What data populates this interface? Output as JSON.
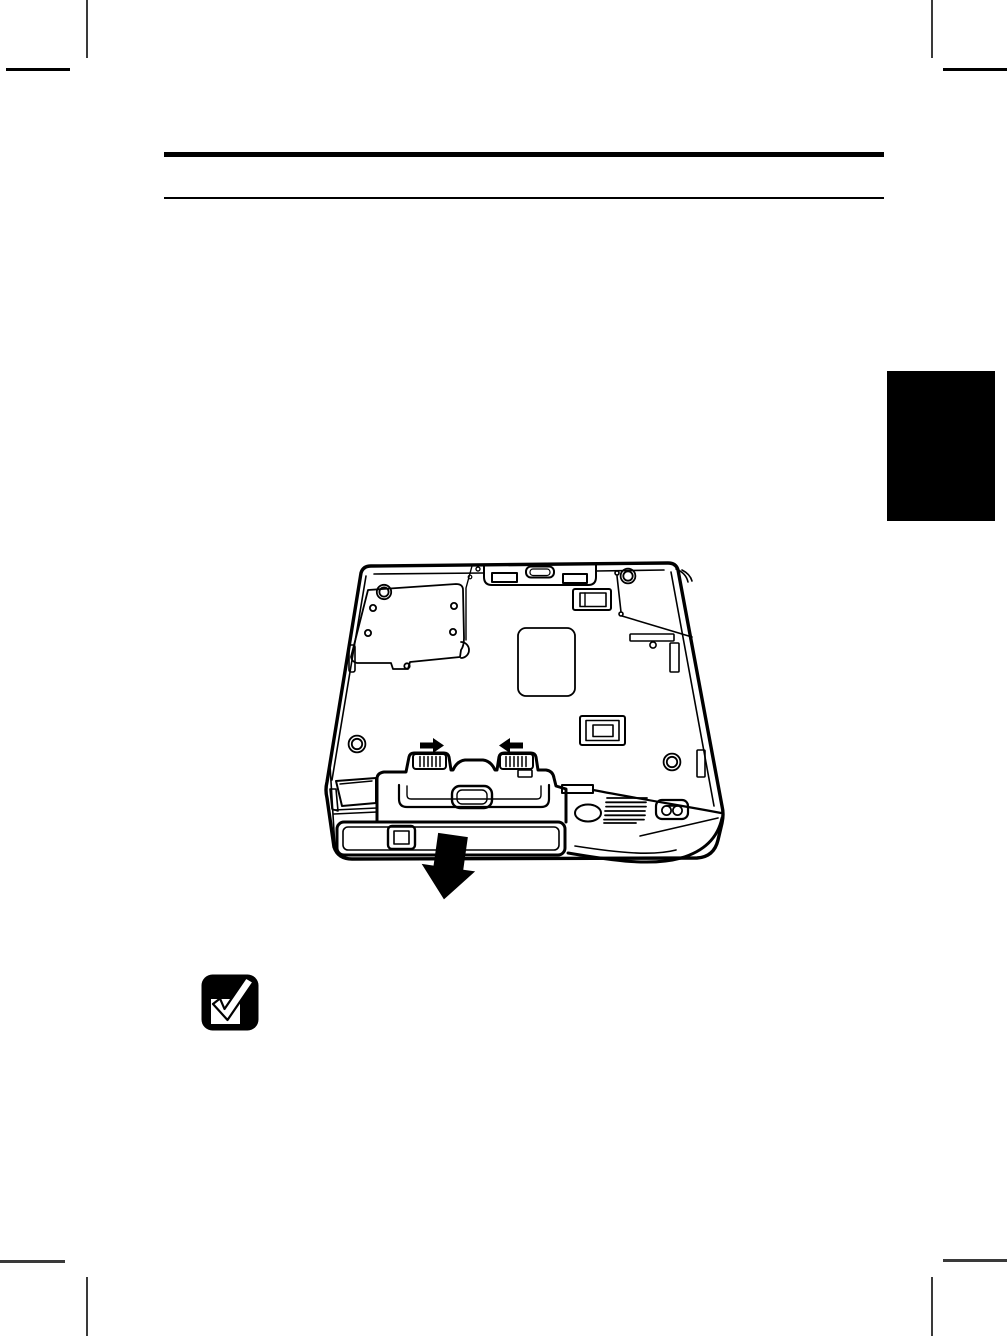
{
  "page": {
    "kind": "printed-manual-page",
    "width_px": 1007,
    "height_px": 1336,
    "background": "#ffffff"
  },
  "colors": {
    "ink": "#000000",
    "chapter_tab": "#000000",
    "header_rules": "#000000",
    "crop_marks": "#3a3a3a"
  },
  "header": {
    "title_text": ""
  },
  "chapter_tab": {
    "label_text": ""
  },
  "figure": {
    "name": "laptop-underside-battery-removal-drawing",
    "icons": [
      "slide-arrow-right-icon",
      "slide-arrow-left-icon",
      "battery-pull-out-arrow-icon"
    ]
  },
  "note": {
    "icon": "checkbox-tick-icon",
    "text": ""
  }
}
